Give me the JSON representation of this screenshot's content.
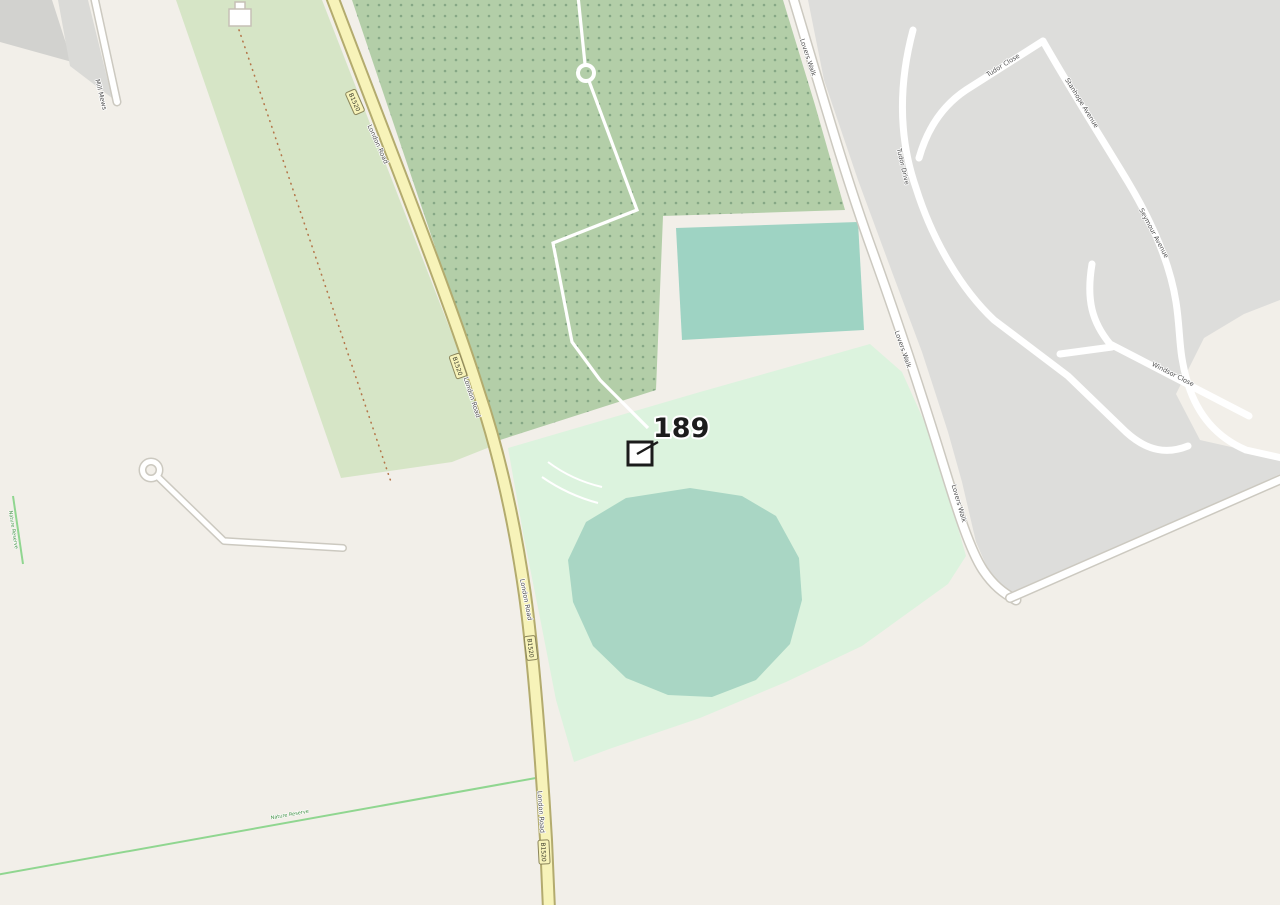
{
  "map_view": {
    "kind": "street-map",
    "marker": {
      "label": "189"
    },
    "roads": {
      "london_road": {
        "name": "London Road",
        "ref": "B1520"
      },
      "lovers_walk": {
        "name": "Lovers Walk"
      },
      "mill_mews": {
        "name": "Mill Mews"
      },
      "tudor_drive": {
        "name": "Tudor Drive"
      },
      "tudor_close": {
        "name": "Tudor Close"
      },
      "stanhope_avenue": {
        "name": "Stanhope Avenue"
      },
      "seymour_avenue": {
        "name": "Seymour Avenue"
      },
      "windsor_close": {
        "name": "Windsor Close"
      }
    },
    "areas": {
      "route_label": "Nature Reserve"
    },
    "colors": {
      "land": "#f2efe9",
      "residential": "#dddddb",
      "allotments_base": "#b3cea8",
      "allotments_dot": "#86a886",
      "farmland_strip": "#d6e5c6",
      "park_mint": "#dcf3de",
      "water_teal": "#a9d6c4",
      "road_secondary_fill": "#f7f3b9",
      "road_secondary_casing": "#b3ab6e",
      "route_green": "#90d690",
      "track_dotted": "#b4764a",
      "marker_outline": "#1b1b1b"
    }
  }
}
